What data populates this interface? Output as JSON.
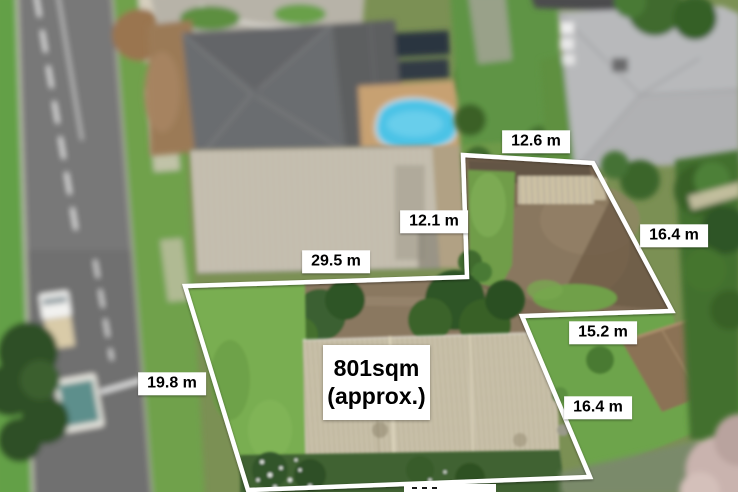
{
  "overlay": {
    "area_label": {
      "line1": "801sqm",
      "line2": "(approx.)"
    },
    "measurements": {
      "rear_top_width": "12.6 m",
      "rear_left_depth": "12.1 m",
      "rear_bottom_width": "29.5 m",
      "rear_right_depth": "16.4 m",
      "mid_right_width": "15.2 m",
      "lower_right_depth": "16.4 m",
      "front_left_depth": "19.8 m",
      "bottom_front_width_clipped": ""
    },
    "style": {
      "boundary_color": "#ffffff",
      "label_background": "#ffffff",
      "label_text_color": "#000000"
    }
  },
  "scene": {
    "colors": {
      "pool": "#4cc3e6",
      "lawn": "#79ae51",
      "rear_yard_dirt": "#7e6b54",
      "road": "#787878",
      "roof_dark_gray": "#6b6d6f",
      "roof_light_corrugated": "#c8c1ad",
      "parked_car_green": "#79bd3f",
      "trees": "#3a6130"
    }
  }
}
